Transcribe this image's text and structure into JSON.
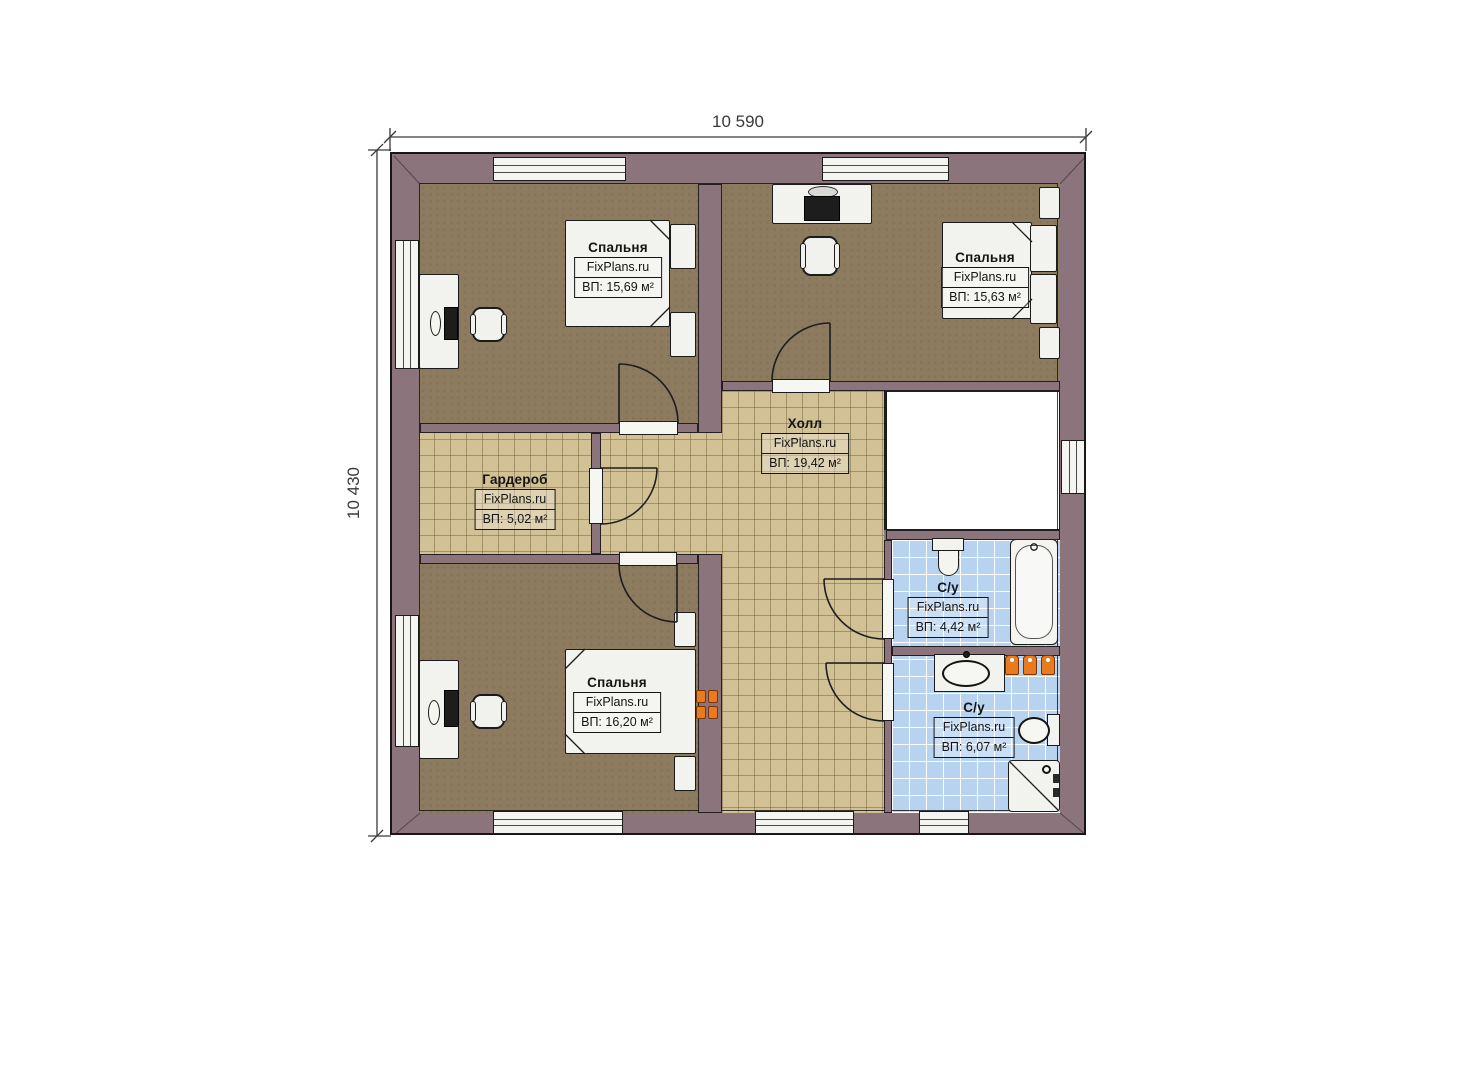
{
  "dimensions": {
    "width": "10 590",
    "height": "10 430"
  },
  "rooms": [
    {
      "id": "bedroom-top-left",
      "name": "Спальня",
      "brand": "FixPlans.ru",
      "area": "ВП: 15,69 м²"
    },
    {
      "id": "bedroom-top-right",
      "name": "Спальня",
      "brand": "FixPlans.ru",
      "area": "ВП: 15,63 м²"
    },
    {
      "id": "hall",
      "name": "Холл",
      "brand": "FixPlans.ru",
      "area": "ВП: 19,42 м²"
    },
    {
      "id": "wardrobe",
      "name": "Гардероб",
      "brand": "FixPlans.ru",
      "area": "ВП: 5,02 м²"
    },
    {
      "id": "bedroom-bottom-left",
      "name": "Спальня",
      "brand": "FixPlans.ru",
      "area": "ВП: 16,20 м²"
    },
    {
      "id": "bathroom-top",
      "name": "С/у",
      "brand": "FixPlans.ru",
      "area": "ВП: 4,42 м²"
    },
    {
      "id": "bathroom-bottom",
      "name": "С/у",
      "brand": "FixPlans.ru",
      "area": "ВП: 6,07 м²"
    }
  ],
  "colors": {
    "wall": "#8b747b",
    "carpet": "#8d7b60",
    "tile": "#d1c195",
    "wet_tile": "#b7d3f0",
    "accent": "#e87a20"
  }
}
